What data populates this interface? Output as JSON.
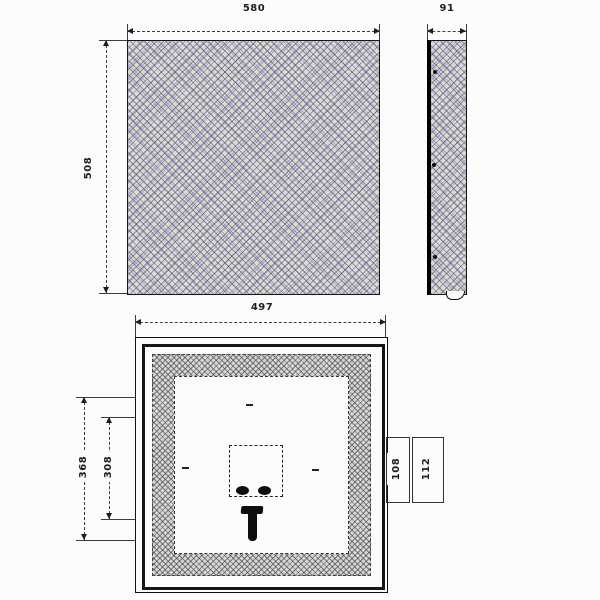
{
  "drawing": {
    "front_view": {
      "width": "580",
      "height": "508"
    },
    "side_view": {
      "depth": "91"
    },
    "rear_view": {
      "width": "497",
      "left_outer": "368",
      "left_inner": "308",
      "right_inner": "108",
      "right_outer": "112"
    },
    "colors": {
      "line": "#1d1d1d",
      "hatch_base": "#dadada",
      "hatch_accent": "#8c84cd",
      "fill_black": "#0d0d0d",
      "background": "#fcfcfc"
    }
  }
}
